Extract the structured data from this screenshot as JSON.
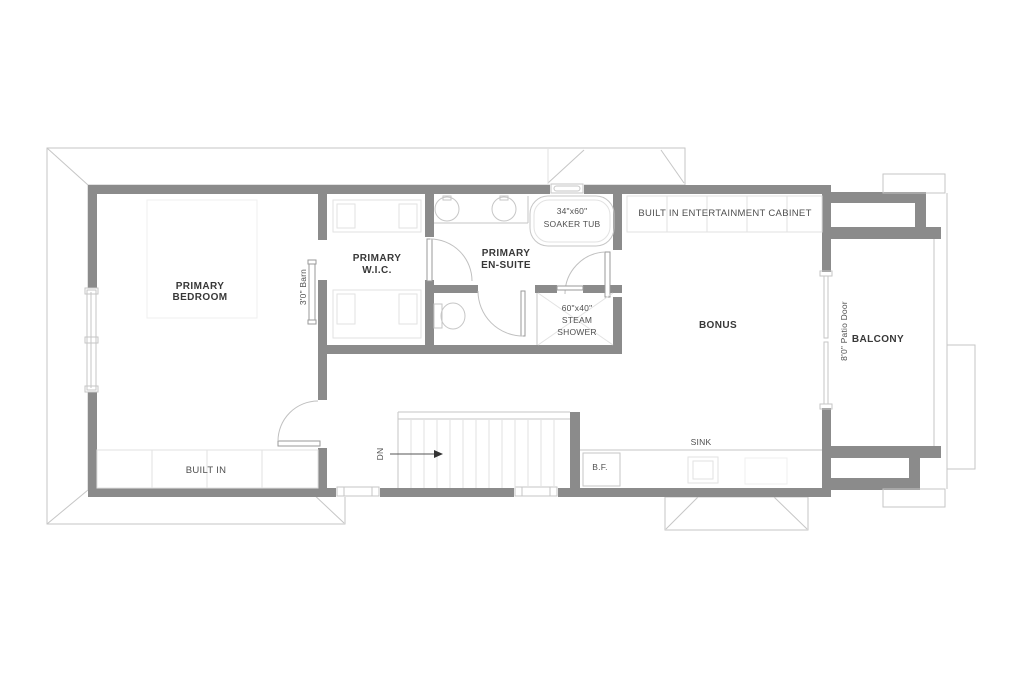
{
  "colors": {
    "wall": "#8b8b8b",
    "bg": "#ffffff",
    "line_light": "#c6c6c6",
    "line_faint": "#e2e2e2",
    "hatch": "#e7e7e7",
    "room_label": "#383838",
    "fixture_label": "#4f4f4f"
  },
  "labels": {
    "primary_bedroom_1": "PRIMARY",
    "primary_bedroom_2": "BEDROOM",
    "wic_1": "PRIMARY",
    "wic_2": "W.I.C.",
    "ensuite_1": "PRIMARY",
    "ensuite_2": "EN-SUITE",
    "soaker_tub_1": "34\"x60\"",
    "soaker_tub_2": "SOAKER TUB",
    "steam_shower_1": "60\"x40\"",
    "steam_shower_2": "STEAM",
    "steam_shower_3": "SHOWER",
    "entertainment_cabinet": "BUILT IN ENTERTAINMENT CABINET",
    "bonus": "BONUS",
    "balcony": "BALCONY",
    "built_in": "BUILT IN",
    "sink": "SINK",
    "bar_fridge": "B.F.",
    "stairs_dn": "DN",
    "barn_door": "3'0\" Barn",
    "patio_door": "8'0\" Patio Door"
  }
}
